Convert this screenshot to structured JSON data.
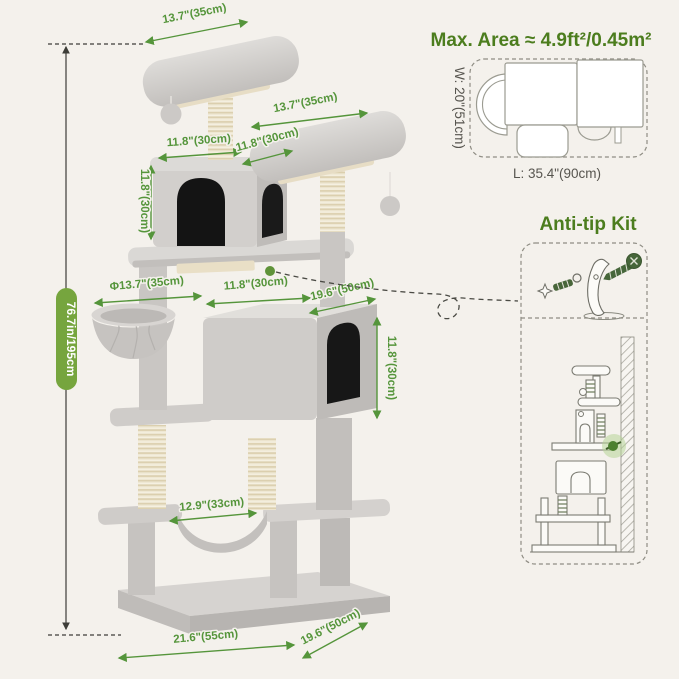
{
  "colors": {
    "background": "#f4f1ec",
    "dimension_green": "#55953b",
    "heading_green": "#4c7d1e",
    "pill_green": "#76a53e",
    "dark_line": "#3d3d38",
    "tree_plush": "#cfccc9",
    "sisal": "#efe8d4",
    "anti_tip_dot": "#4d8030"
  },
  "dimensions": {
    "top_platform_width": "13.7\"(35cm)",
    "second_platform_width": "13.7\"(35cm)",
    "upper_condo_width": "11.8\"(30cm)",
    "upper_condo_depth": "11.8\"(30cm)",
    "upper_condo_height": "11.8\"(30cm)",
    "basket_diameter": "Φ13.7\"(35cm)",
    "large_condo_width": "11.8\"(30cm)",
    "large_condo_depth": "19.6\"(50cm)",
    "large_condo_height": "11.8\"(30cm)",
    "lower_hammock_width": "12.9\"(33cm)",
    "base_width": "21.6\"(55cm)",
    "base_depth": "19.6\"(50cm)",
    "total_height": "76.7in/195cm"
  },
  "top_view": {
    "title": "Max. Area ≈ 4.9ft²/0.45m²",
    "width_label": "W: 20\"(51cm)",
    "length_label": "L: 35.4\"(90cm)"
  },
  "anti_tip": {
    "title": "Anti-tip Kit"
  }
}
